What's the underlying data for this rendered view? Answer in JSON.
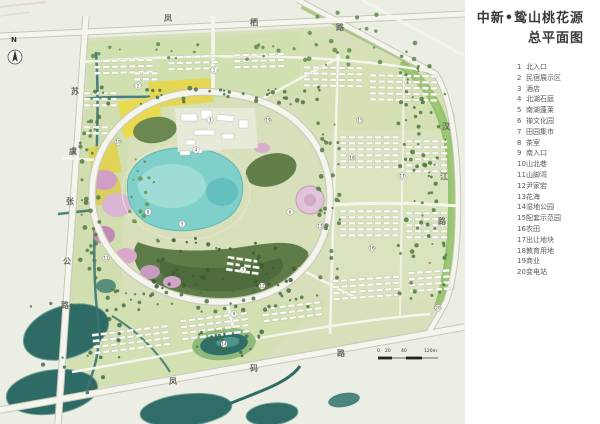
{
  "title": {
    "line1": "中新•鸷山桃花源",
    "line2": "总平面图"
  },
  "legend": {
    "items": [
      {
        "num": "1",
        "label": "北入口"
      },
      {
        "num": "2",
        "label": "民宿展示区"
      },
      {
        "num": "3",
        "label": "酒店"
      },
      {
        "num": "4",
        "label": "北湖石庭"
      },
      {
        "num": "5",
        "label": "南湖蓬莱"
      },
      {
        "num": "6",
        "label": "禅文化园"
      },
      {
        "num": "7",
        "label": "田园集市"
      },
      {
        "num": "8",
        "label": "茶室"
      },
      {
        "num": "9",
        "label": "南入口"
      },
      {
        "num": "10",
        "label": "山北巷"
      },
      {
        "num": "11",
        "label": "山脚湾"
      },
      {
        "num": "12",
        "label": "尹家宕"
      },
      {
        "num": "13",
        "label": "花海"
      },
      {
        "num": "14",
        "label": "湿地公园"
      },
      {
        "num": "15",
        "label": "配套示范园"
      },
      {
        "num": "16",
        "label": "农田"
      },
      {
        "num": "17",
        "label": "出让地块"
      },
      {
        "num": "18",
        "label": "教育用地"
      },
      {
        "num": "19",
        "label": "商业"
      },
      {
        "num": "20",
        "label": "变电站"
      }
    ]
  },
  "map": {
    "north_label": "N",
    "roads": {
      "top": {
        "name": "凤栖路",
        "chars": [
          "凤",
          "栖",
          "路"
        ]
      },
      "left": {
        "name": "苏虞张公路",
        "chars": [
          "苏",
          "虞",
          "张",
          "公",
          "路"
        ]
      },
      "right": {
        "name": "汉江路",
        "chars": [
          "汉",
          "江",
          "路"
        ]
      },
      "bottom": {
        "name": "凤码路",
        "chars": [
          "凤",
          "码",
          "路"
        ]
      }
    },
    "scale": {
      "labels": [
        "0",
        "20",
        "40",
        "120m"
      ]
    },
    "colors": {
      "background": "#eceee3",
      "site_green": "#d7e0ba",
      "lake": "#7fd0ca",
      "hill": "#5e7c47",
      "blossom_pink": "#d3a4c9",
      "field_yellow": "#e6d64f",
      "dark_water": "#2f6b66",
      "road_white": "#f5f5ee",
      "tree_green": "#4e7340"
    }
  }
}
